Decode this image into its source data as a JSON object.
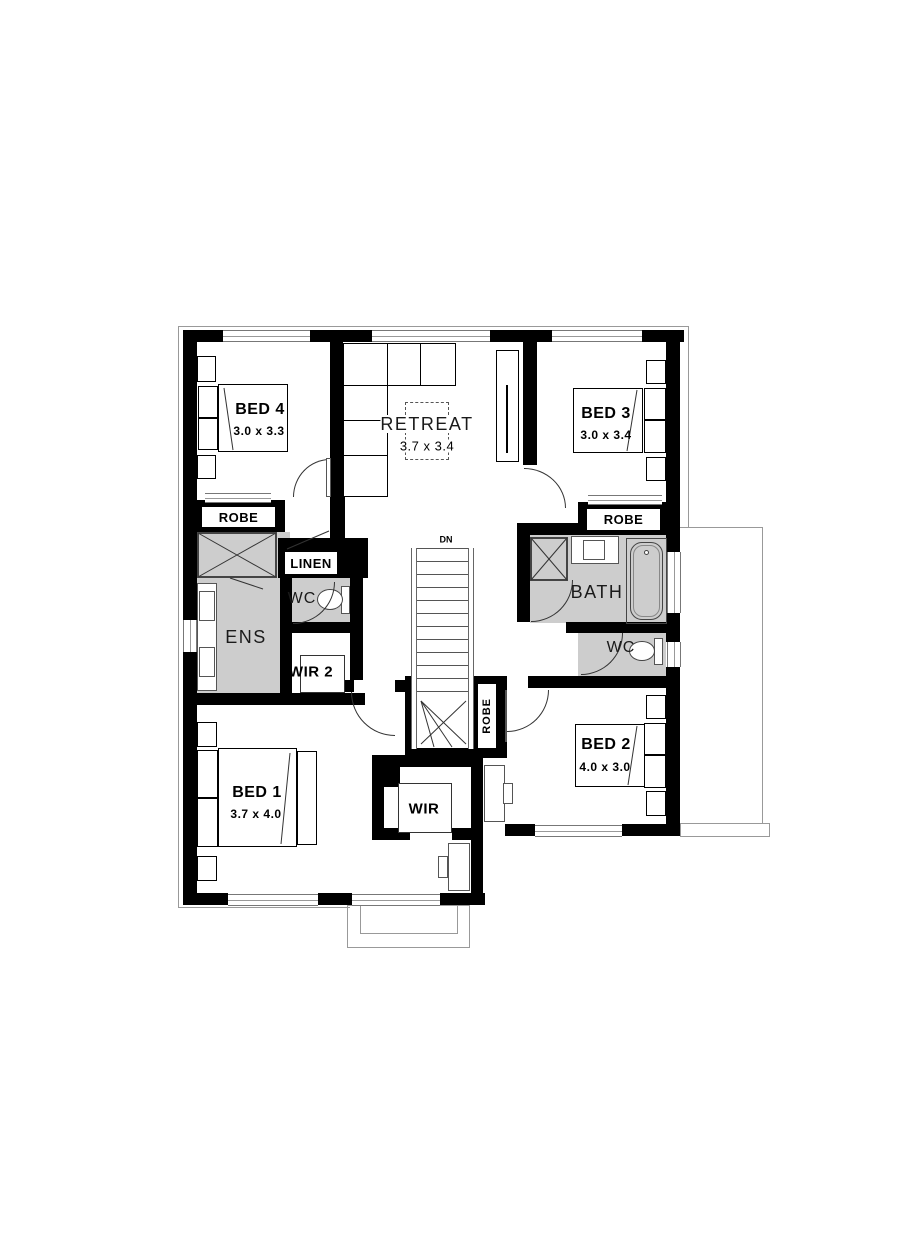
{
  "rooms": {
    "bed4": {
      "name": "BED 4",
      "dims": "3.0 x 3.3"
    },
    "retreat": {
      "name": "RETREAT",
      "dims": "3.7 x 3.4"
    },
    "bed3": {
      "name": "BED 3",
      "dims": "3.0 x 3.4"
    },
    "bed1": {
      "name": "BED 1",
      "dims": "3.7 x 4.0"
    },
    "bed2": {
      "name": "BED 2",
      "dims": "4.0 x 3.0"
    },
    "ens": {
      "name": "ENS"
    },
    "bath": {
      "name": "BATH"
    },
    "wc_left": {
      "name": "WC"
    },
    "wc_right": {
      "name": "WC"
    },
    "wir": {
      "name": "WIR"
    },
    "wir2": {
      "name": "WIR 2"
    },
    "linen": {
      "name": "LINEN"
    },
    "robe_left": {
      "name": "ROBE"
    },
    "robe_right": {
      "name": "ROBE"
    },
    "robe_hall": {
      "name": "ROBE"
    },
    "stairs": {
      "direction": "DN"
    }
  },
  "colors": {
    "wall": "#000000",
    "wet_area_floor": "#cdcdcd",
    "outline": "#999999"
  }
}
